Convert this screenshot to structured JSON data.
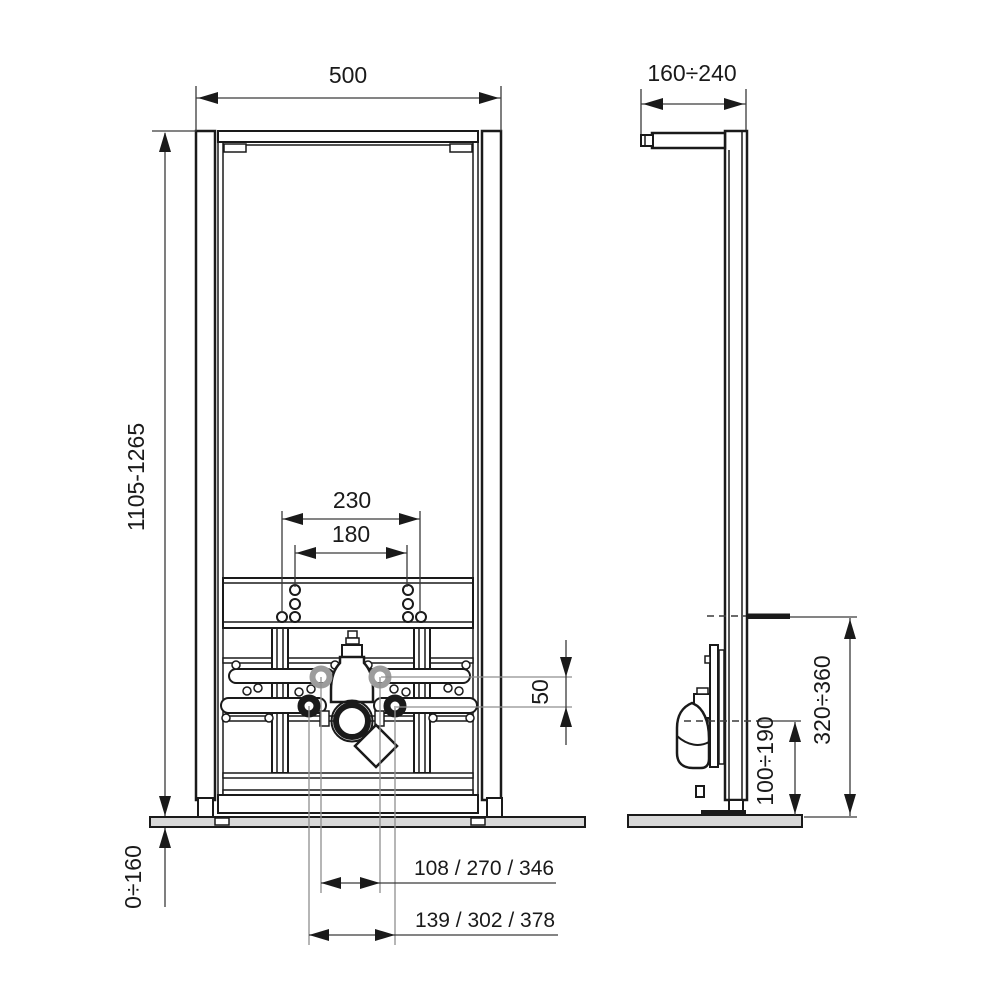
{
  "drawing": {
    "dims": {
      "frame_width": "500",
      "wall_depth": "160÷240",
      "frame_height": "1105-1265",
      "hole_spacing_outer": "230",
      "hole_spacing_inner": "180",
      "connection_offset": "50",
      "floor_adjust": "0÷160",
      "stud_height": "320÷360",
      "drain_height": "100÷190",
      "inner_spacing_options": "108 / 270 / 346",
      "outer_spacing_options": "139 / 302 / 378"
    },
    "colors": {
      "line": "#1a1a1a",
      "dimension": "#3a3a3a",
      "centerline": "#8f8f8f",
      "floor_fill": "#d8d8d8",
      "pipe_gray": "#9c9c9c",
      "background": "#ffffff"
    }
  }
}
